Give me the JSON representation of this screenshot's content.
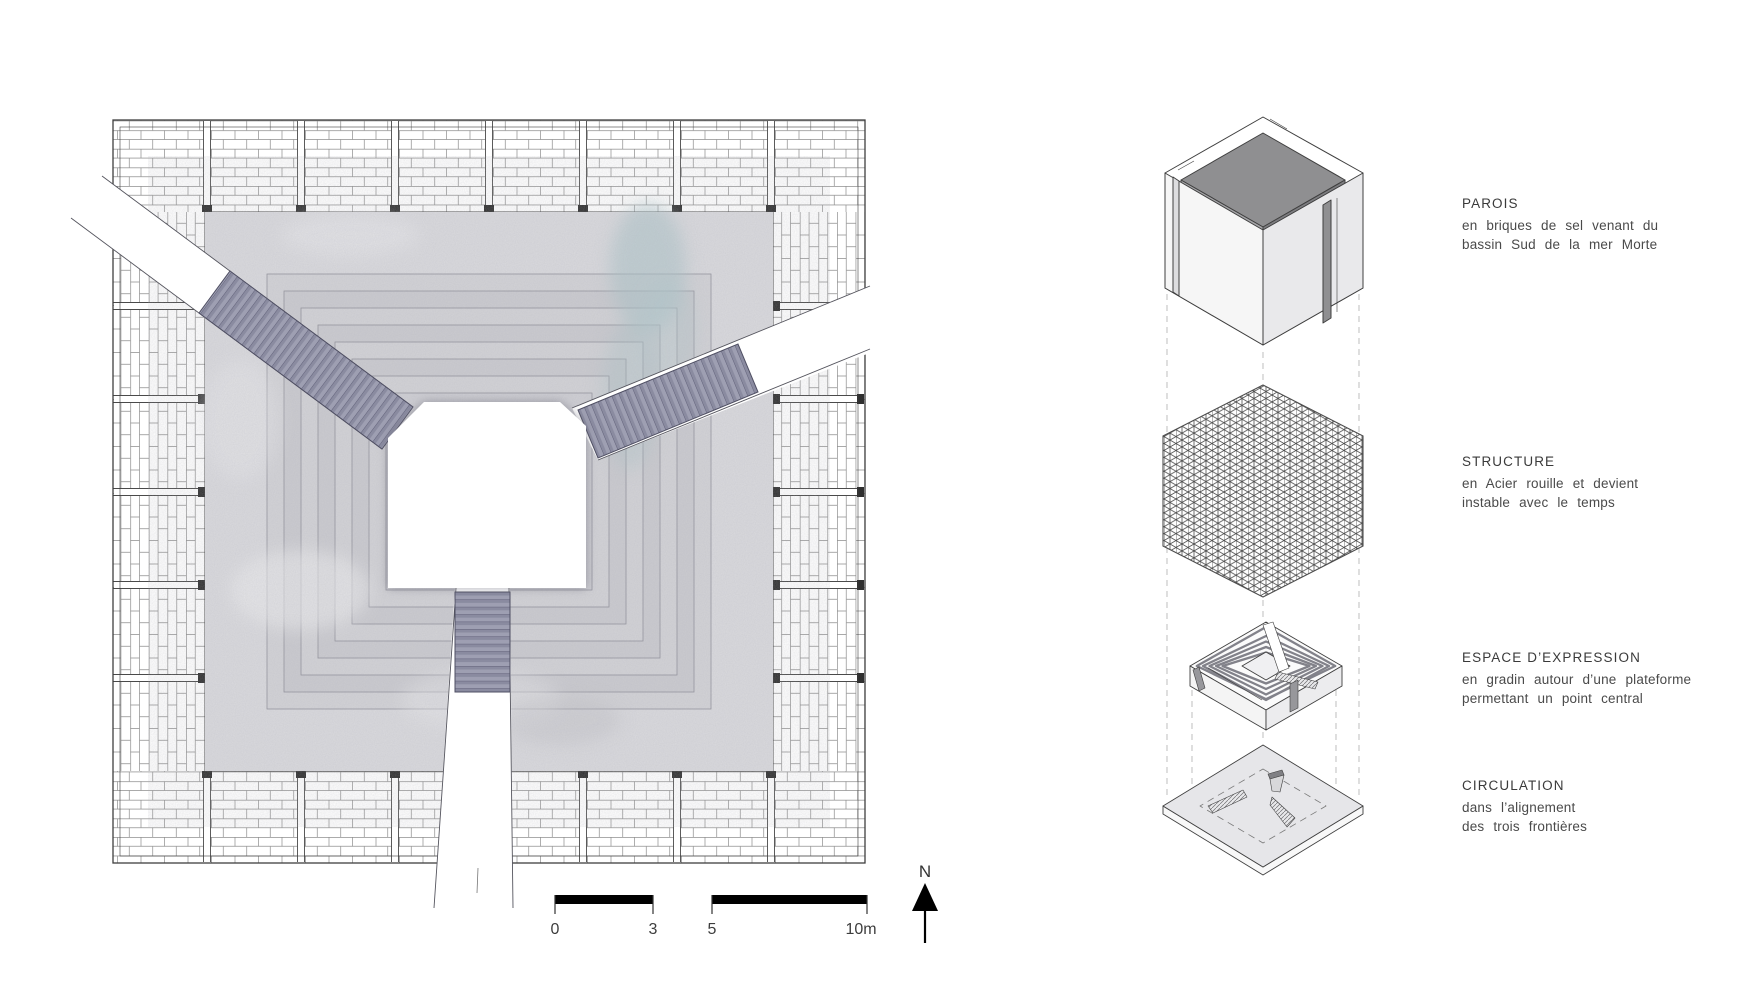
{
  "plan": {
    "scale_bar": {
      "labels": [
        "0",
        "3",
        "5",
        "10m"
      ]
    },
    "north_label": "N"
  },
  "legend": {
    "items": [
      {
        "title": "PAROIS",
        "line1": "en briques de sel venant du",
        "line2": "bassin Sud de la mer Morte"
      },
      {
        "title": "STRUCTURE",
        "line1": "en Acier rouille et devient",
        "line2": "instable avec le temps"
      },
      {
        "title": "ESPACE D’EXPRESSION",
        "line1": "en gradin autour d’une plateforme",
        "line2": "permettant un point central"
      },
      {
        "title": "CIRCULATION",
        "line1": "dans l’alignement",
        "line2": "des trois frontières"
      }
    ]
  },
  "colors": {
    "ink": "#3f3f3f",
    "stone_floor": "#dadade",
    "stair": "#9e9fb2",
    "stain_teal": "#a9c3c6",
    "guide_dash": "#b8b8b8"
  }
}
